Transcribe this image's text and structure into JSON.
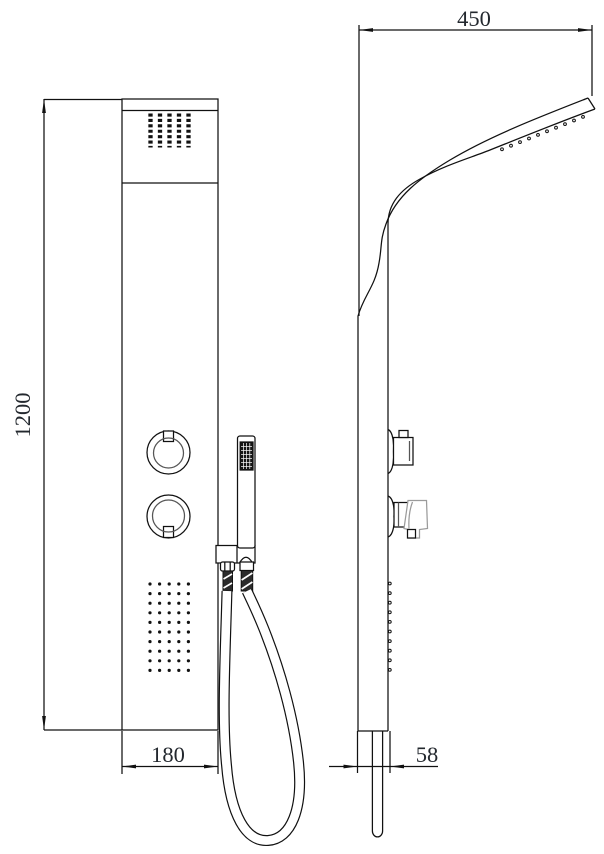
{
  "drawing": {
    "title": "shower-panel-technical-drawing",
    "dimensions": {
      "height_label": "1200",
      "depth_label": "450",
      "width_label": "180",
      "thickness_label": "58"
    },
    "colors": {
      "line": "#111111",
      "accent_gray": "#9b9b9b",
      "background": "#ffffff",
      "text": "#23282e"
    }
  }
}
